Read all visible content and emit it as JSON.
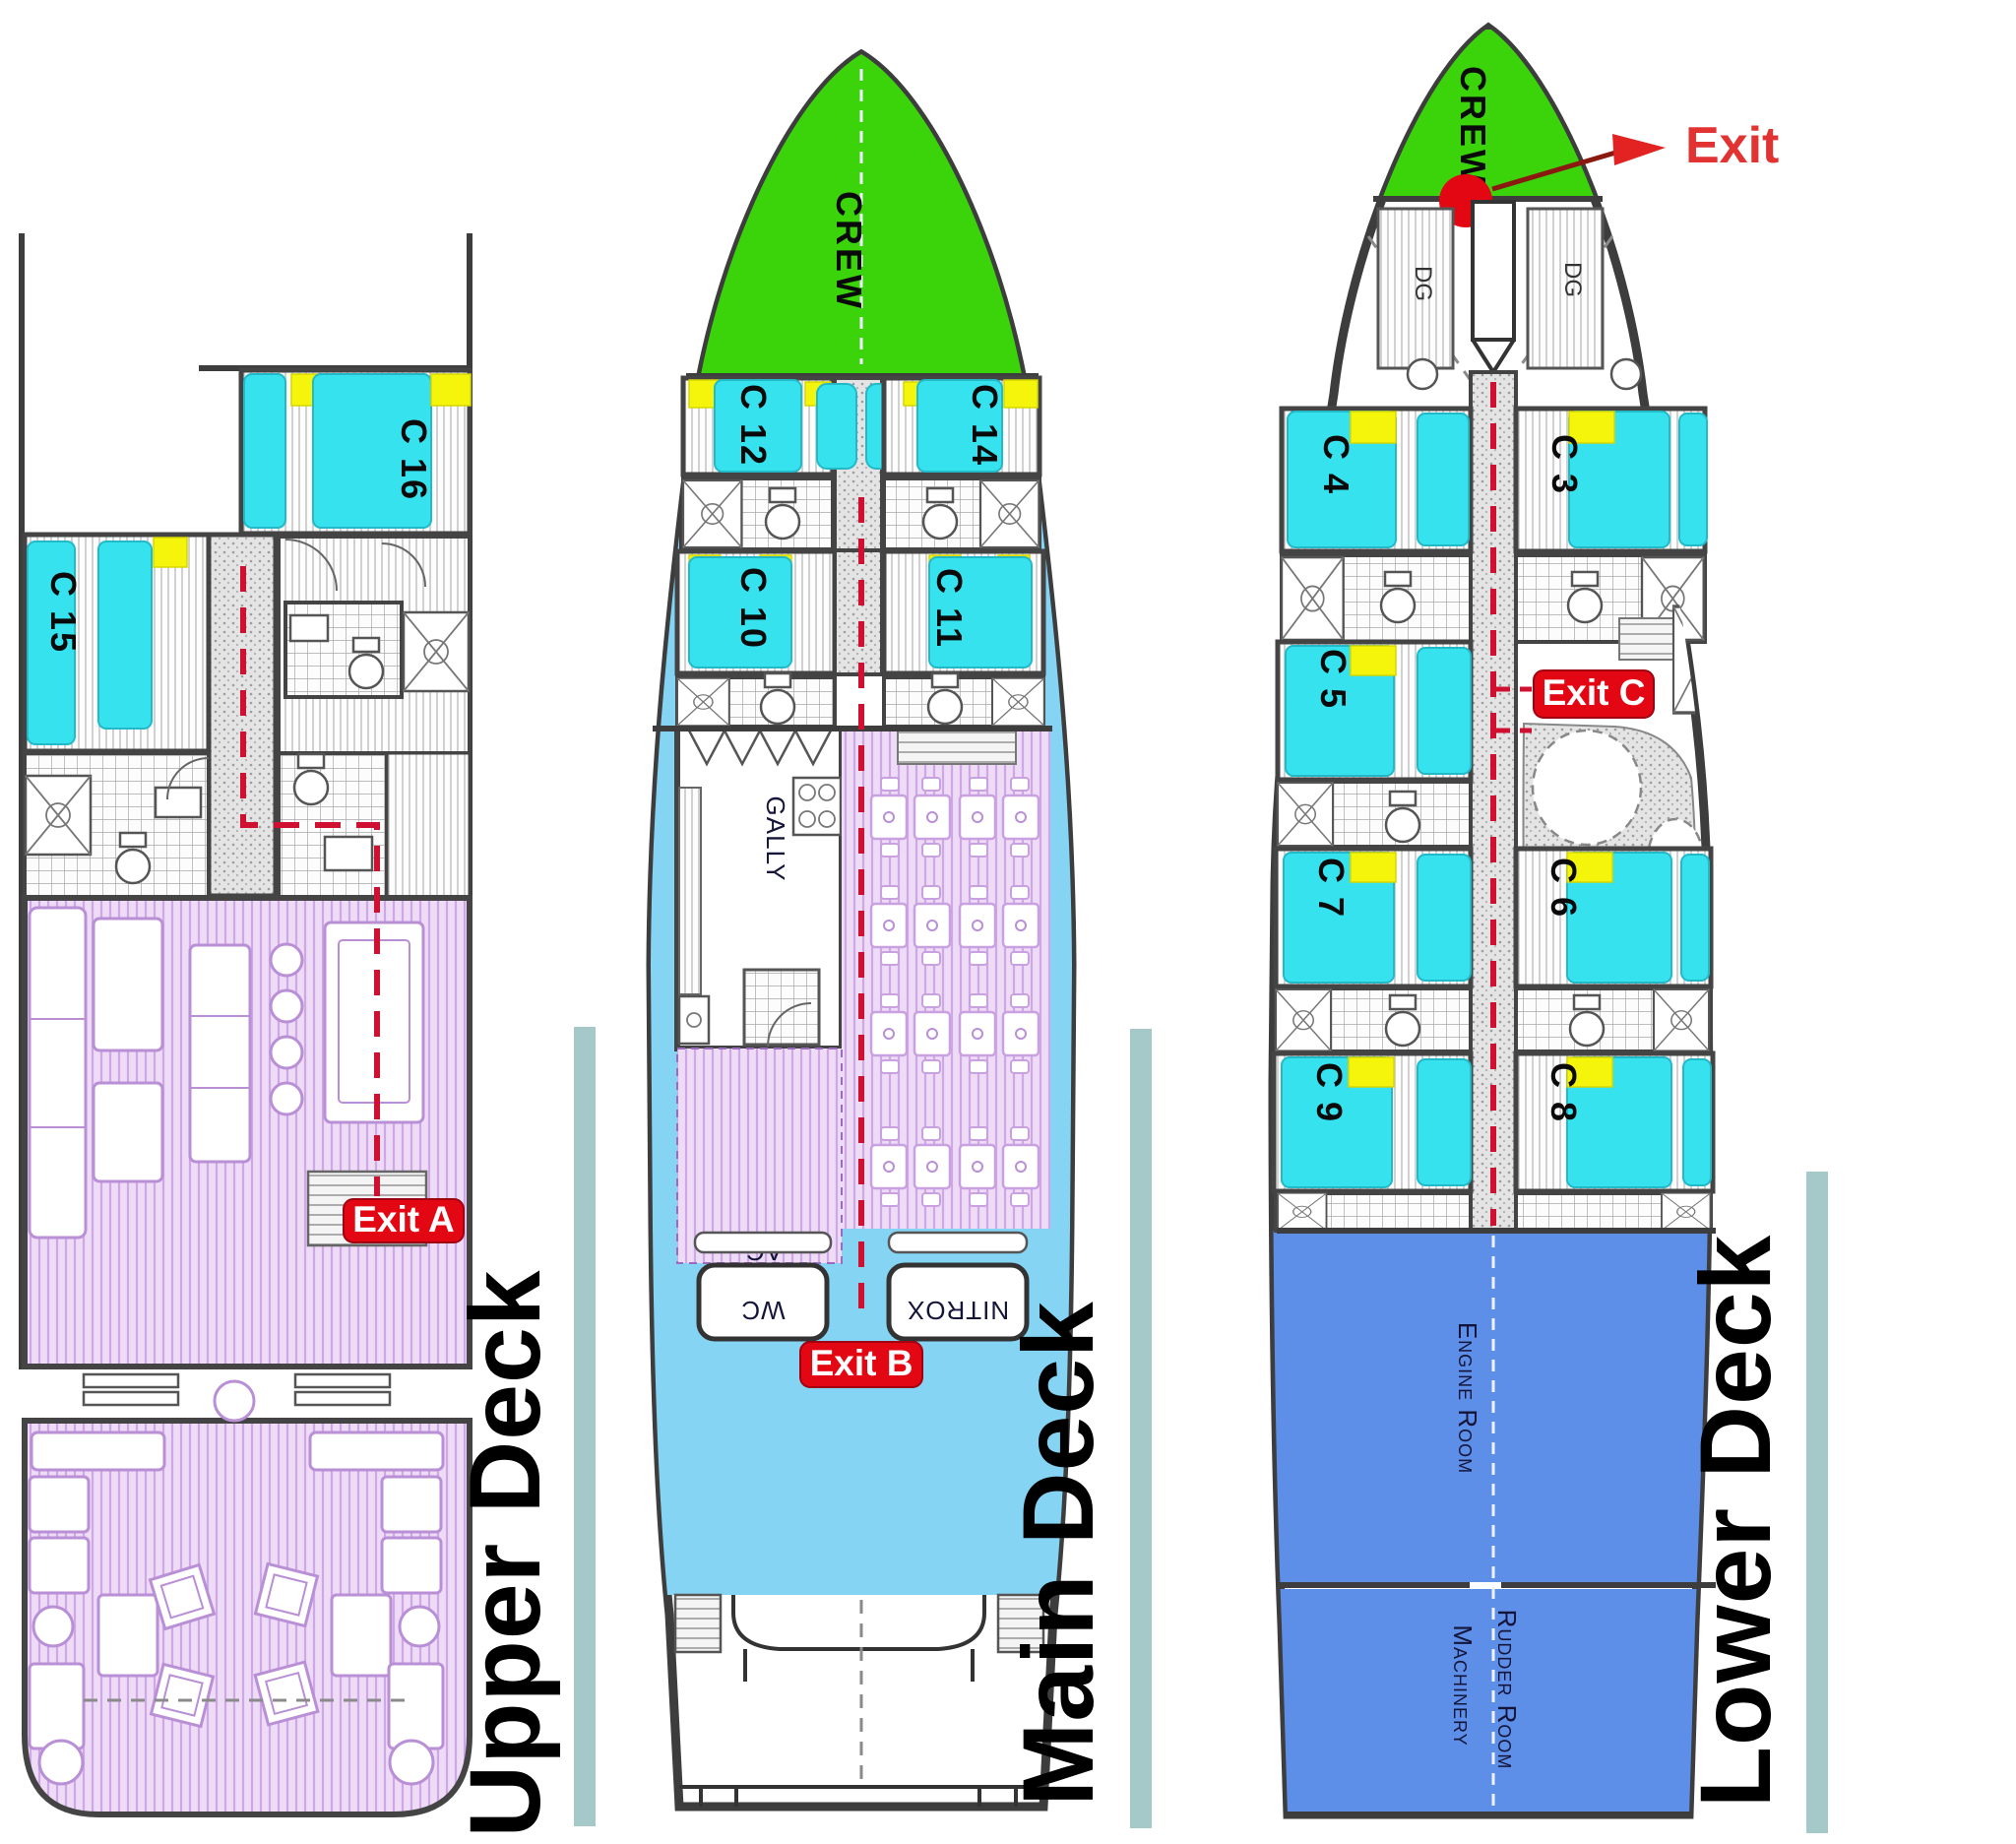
{
  "diagram": "boat-deck-plans",
  "colors": {
    "crew_area_green": "#3bd40b",
    "bed_cyan": "#35e2ee",
    "pillow_yellow": "#f5f50c",
    "lounge_lavender": "#e4cdf1",
    "walkway_lightblue": "#85d4f3",
    "engine_blue": "#5d8ee8",
    "exit_red": "#e30613",
    "sidebar_teal": "#a5c8c9"
  },
  "upper_deck": {
    "title": "Upper Deck",
    "cabin_c16": "C 16",
    "cabin_c15": "C 15",
    "exit_a": "Exit A"
  },
  "main_deck": {
    "title": "Main Deck",
    "crew": "CREW",
    "cabin_c12": "C 12",
    "cabin_c14": "C 14",
    "cabin_c10": "C 10",
    "cabin_c11": "C 11",
    "galley": "GALLY",
    "ac": "AC",
    "wc": "WC",
    "nitrox": "NITROX",
    "exit_b": "Exit B"
  },
  "lower_deck": {
    "title": "Lower Deck",
    "crew": "CREW",
    "exit_top": "Exit",
    "dg_left": "DG",
    "dg_right": "DG",
    "cabin_c4": "C 4",
    "cabin_c3": "C 3",
    "cabin_c5": "C 5",
    "cabin_c7": "C 7",
    "cabin_c6": "C 6",
    "cabin_c9": "C 9",
    "cabin_c8": "C 8",
    "exit_c": "Exit C",
    "engine_room": "Engine Room",
    "machinery": "Machinery",
    "rudder_room": "Rudder Room"
  }
}
